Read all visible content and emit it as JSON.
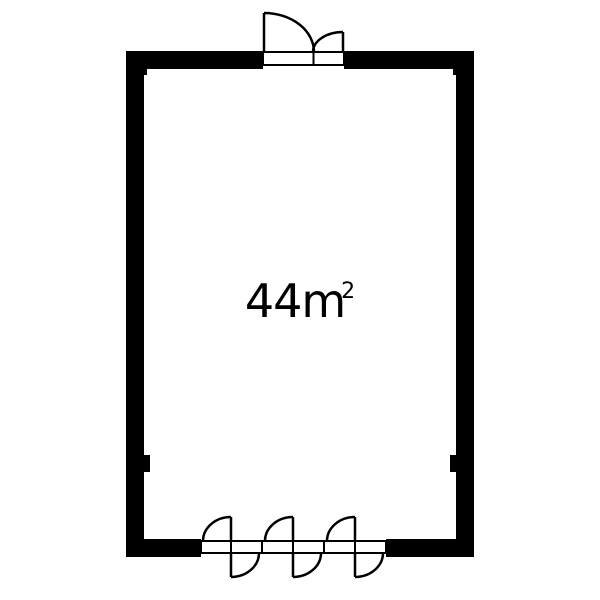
{
  "page": {
    "background_color": "#ffffff"
  },
  "floorplan": {
    "name": "single-room-floor-plan",
    "area": {
      "label": "44m",
      "superscript": "2",
      "display": "44m²"
    },
    "colors": {
      "wall": "#000000",
      "floor": "#ffffff",
      "line": "#000000",
      "text": "#000000"
    },
    "doors": {
      "top_door": {
        "name": "double-swing-entry-door",
        "leaf_count": 2
      },
      "bottom_door": {
        "name": "multi-leaf-folding-door",
        "leaf_count": 6
      }
    }
  }
}
